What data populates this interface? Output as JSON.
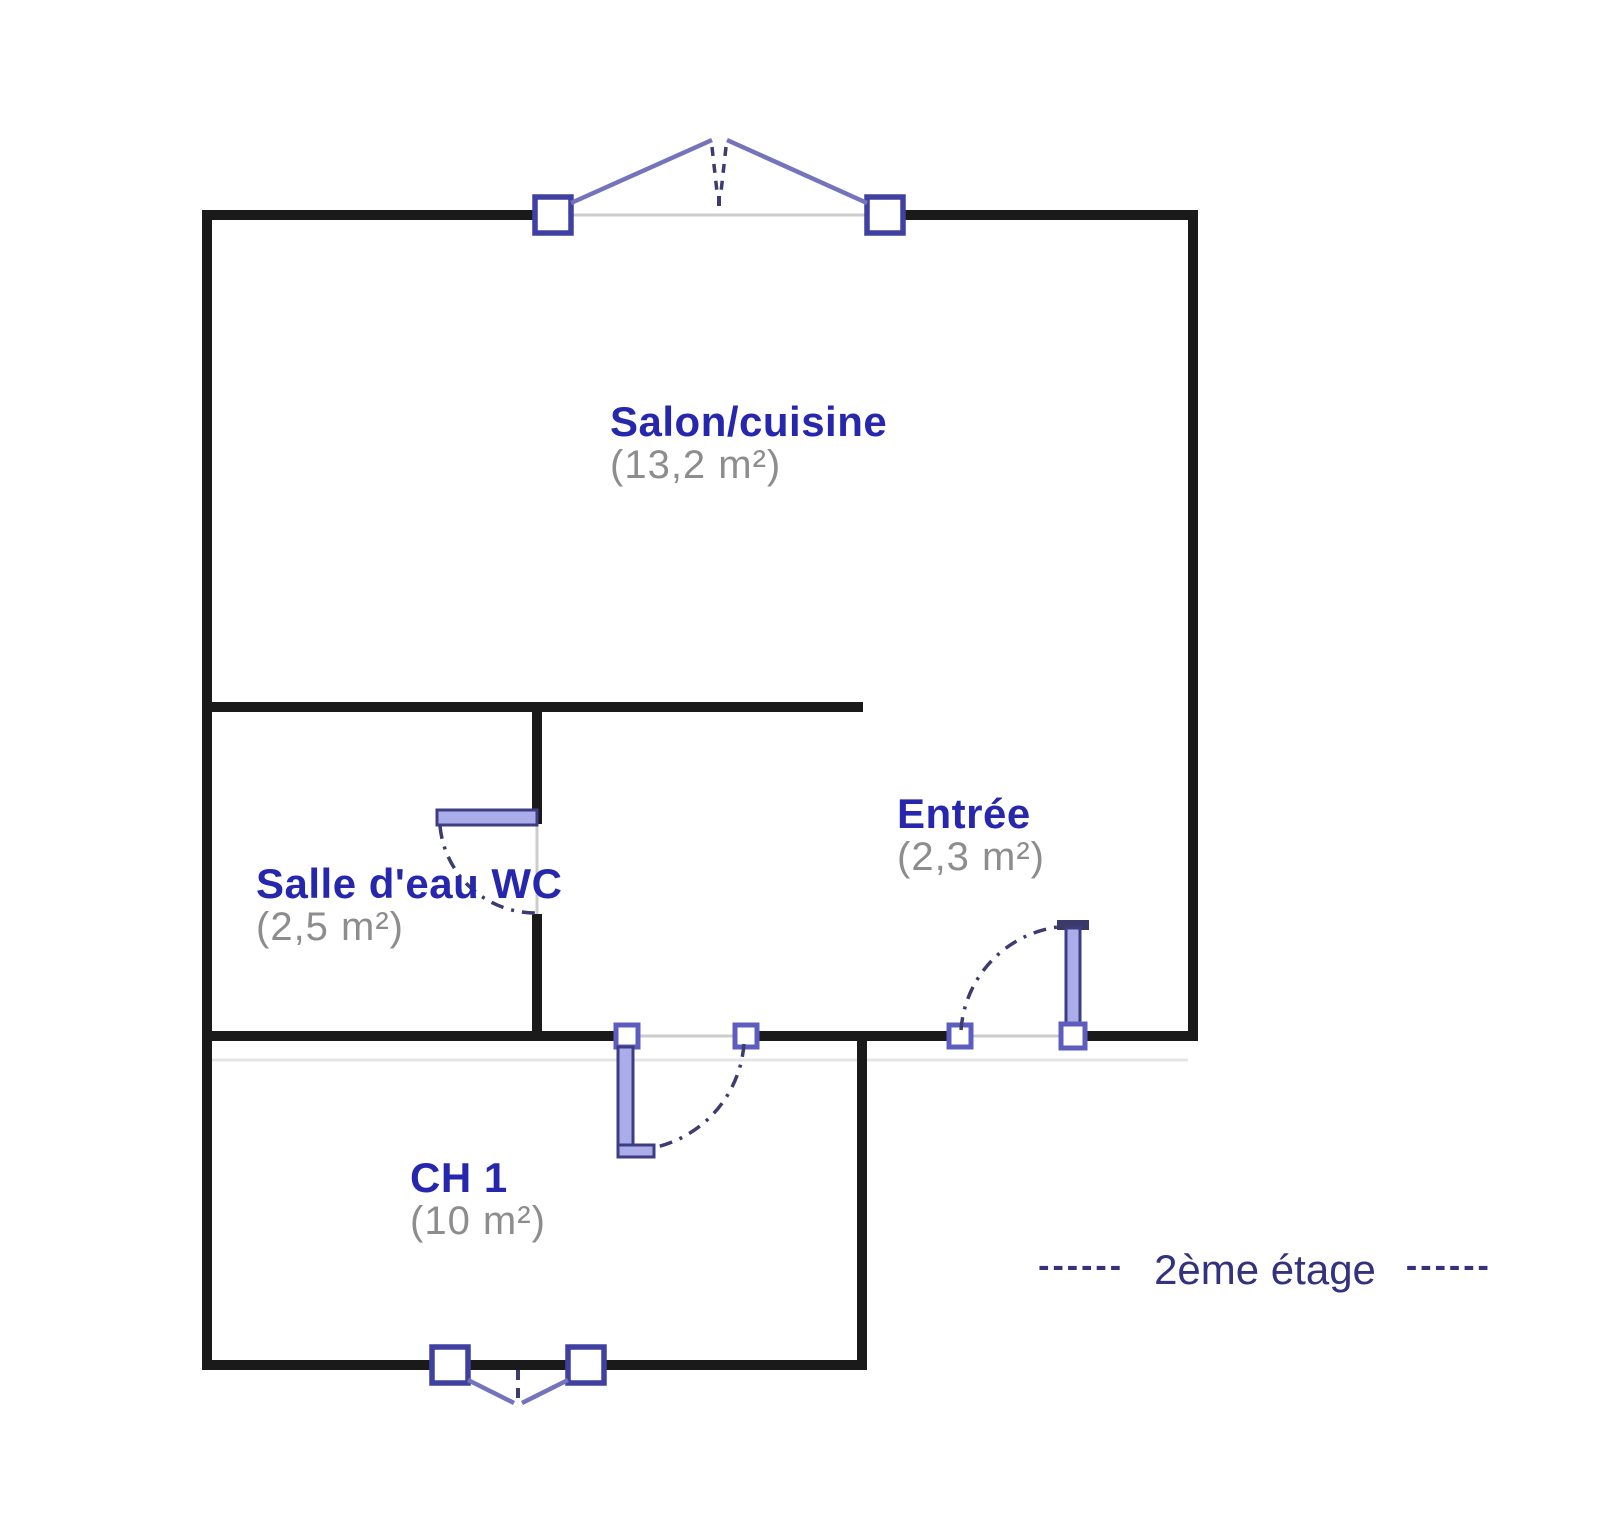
{
  "plan": {
    "rooms": [
      {
        "name": "Salon/cuisine",
        "area": "(13,2 m²)"
      },
      {
        "name": "Salle d'eau WC",
        "area": "(2,5 m²)"
      },
      {
        "name": "Entrée",
        "area": "(2,3 m²)"
      },
      {
        "name": "CH 1",
        "area": "(10 m²)"
      }
    ],
    "floor_caption": {
      "dashes_left": "------",
      "label": "2ème étage",
      "dashes_right": "------"
    },
    "colors": {
      "wall": "#1a1a1a",
      "wall_opening": "#cccccc",
      "wall_shadow": "#e6e6e6",
      "window_frame": "#4040a0",
      "casement_line": "#7474bc",
      "swing_arc": "#3c3c6e",
      "door_leaf_fill": "#abadea",
      "door_leaf_outline": "#3d3d82",
      "hinge_frame": "#5d5dc0",
      "room_name_text": "#2727ae",
      "room_area_text": "#8d8d8d",
      "floor_caption_text": "#32327e"
    }
  }
}
